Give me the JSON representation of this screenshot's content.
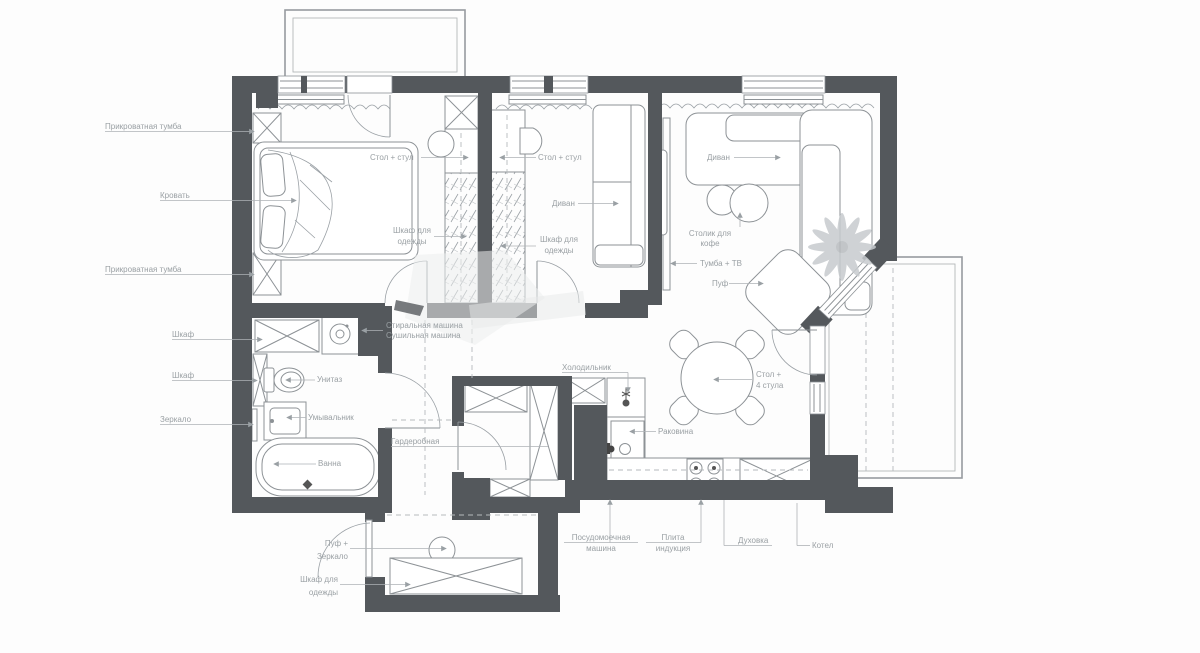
{
  "colors": {
    "wall": "#54585c",
    "furniture_line": "#8d9296",
    "label_text": "#9aa0a4",
    "leader_line": "#aeb2b6",
    "plant": "#c7cbce"
  },
  "labels": {
    "bedside_top": "Прикроватная тумба",
    "bed": "Кровать",
    "bedside_bottom": "Прикроватная тумба",
    "cabinet_top": "Шкаф",
    "cabinet_mid": "Шкаф",
    "mirror": "Зеркало",
    "desk1": "Стол + стул",
    "desk2": "Стол + стул",
    "wardrobe1_l1": "Шкаф для",
    "wardrobe1_l2": "одежды",
    "wardrobe2_l1": "Шкаф для",
    "wardrobe2_l2": "одежды",
    "sofa2": "Диван",
    "sofa_living": "Диван",
    "coffee_l1": "Столик для",
    "coffee_l2": "кофе",
    "tv": "Тумба + ТВ",
    "pouf_living": "Пуф",
    "washer": "Стиральная машина",
    "dryer": "Сушильная машина",
    "toilet": "Унитаз",
    "washbasin": "Умывальник",
    "bath": "Ванна",
    "walkin_closet": "Гардеробная",
    "fridge": "Холодильник",
    "kitchen_sink": "Раковина",
    "dining_l1": "Стол +",
    "dining_l2": "4 стула",
    "dishwasher_l1": "Посудомоечная",
    "dishwasher_l2": "машина",
    "stove_l1": "Плита",
    "stove_l2": "индукция",
    "oven": "Духовка",
    "boiler": "Котел",
    "hall_pouf_l1": "Пуф +",
    "hall_pouf_l2": "Зеркало",
    "hall_wardrobe_l1": "Шкаф для",
    "hall_wardrobe_l2": "одежды"
  }
}
